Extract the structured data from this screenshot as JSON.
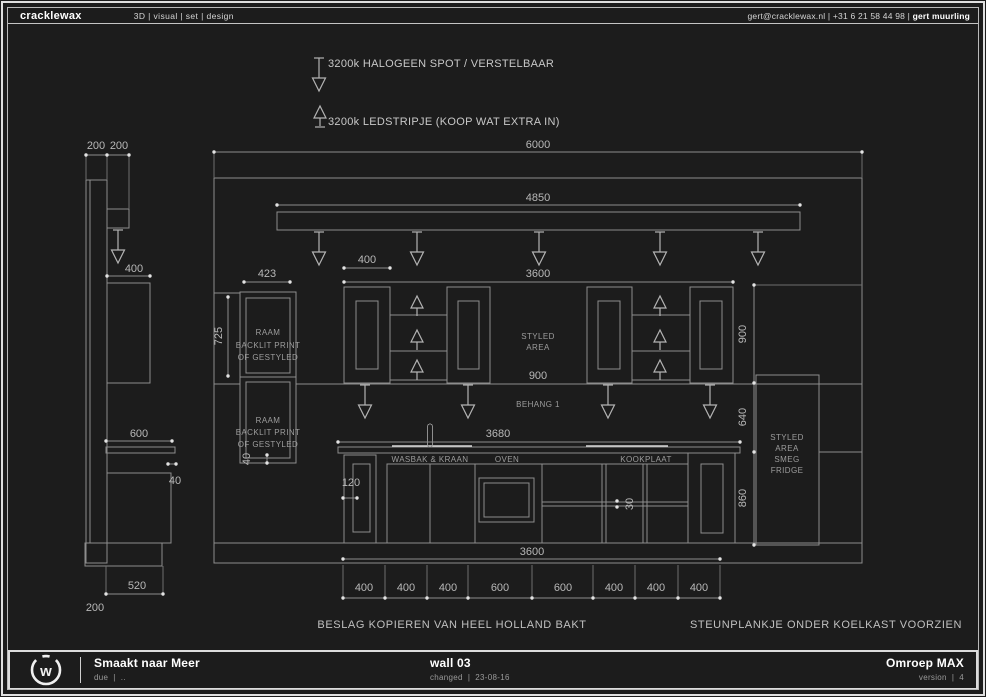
{
  "header": {
    "brand": "cracklewax",
    "nav": "3D | visual | set | design",
    "contact": "gert@cracklewax.nl  |  +31 6 21 58 44 98  |",
    "author": "gert muurling"
  },
  "legend": {
    "halogen": "3200k HALOGEEN SPOT / VERSTELBAAR",
    "ledstrip": "3200k LEDSTRIPJE (KOOP WAT EXTRA IN)"
  },
  "side_view": {
    "dim_200a": "200",
    "dim_200b": "200",
    "dim_400": "400",
    "dim_600": "600",
    "dim_40": "40",
    "dim_520": "520",
    "dim_200c": "200"
  },
  "elevation": {
    "dim_total": "6000",
    "dim_rail": "4850",
    "dim_upper_row": "3600",
    "dim_door": "400",
    "dim_raam_w": "423",
    "dim_raam_h": "725",
    "dim_raam_40": "40",
    "raam_line1": "RAAM",
    "raam_line2": "BACKLIT PRINT",
    "raam_line3": "OF GESTYLED",
    "styled1": "STYLED",
    "styled2": "AREA",
    "dim_mid_900": "900",
    "behang": "BEHANG 1",
    "dim_right_900": "900",
    "dim_right_640": "640",
    "dim_right_860": "860",
    "dim_counter_3680": "3680",
    "label_wasbak": "WASBAK & KRAAN",
    "label_oven": "OVEN",
    "label_kookplaat": "KOOKPLAAT",
    "dim_120": "120",
    "dim_30": "30",
    "fridge1": "STYLED",
    "fridge2": "AREA",
    "fridge3": "SMEG",
    "fridge4": "FRIDGE",
    "dim_base_row": "3600",
    "segments": [
      "400",
      "400",
      "400",
      "600",
      "600",
      "400",
      "400",
      "400"
    ]
  },
  "notes": {
    "left": "BESLAG KOPIEREN VAN HEEL HOLLAND BAKT",
    "right": "STEUNPLANKJE ONDER KOELKAST VOORZIEN"
  },
  "footer": {
    "logo_letter": "w",
    "project": "Smaakt naar Meer",
    "due": "due  |  ..",
    "sheet": "wall 03",
    "changed": "changed  |  23-08-16",
    "client": "Omroep MAX",
    "version": "version  |  4"
  }
}
